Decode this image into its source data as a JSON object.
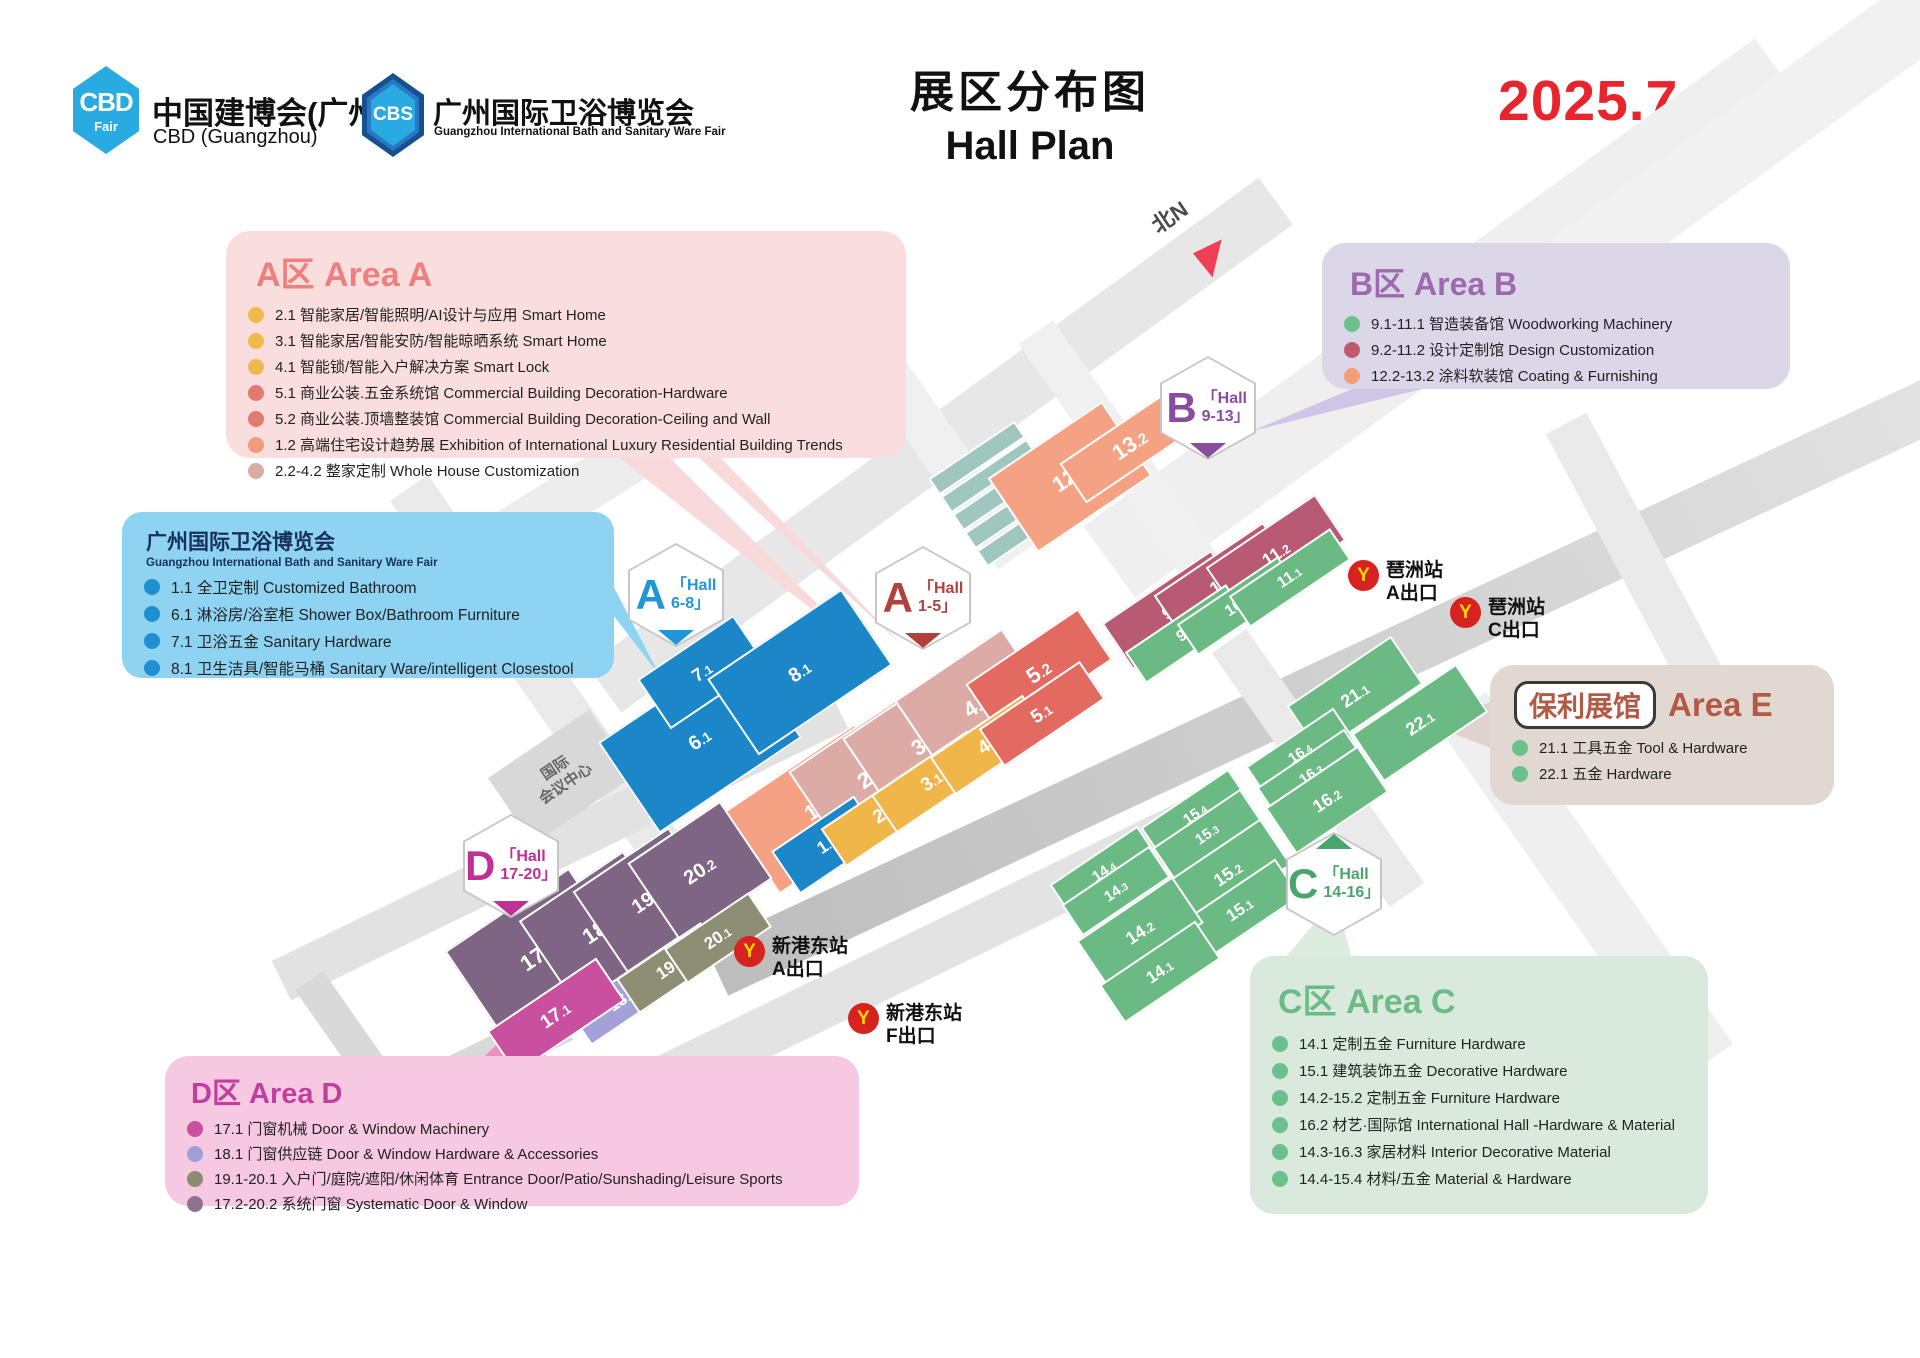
{
  "header": {
    "cbd_logo": {
      "line1": "CBD",
      "line2": "Fair"
    },
    "cbd_title": "中国建博会(广州)",
    "cbd_subtitle": "CBD (Guangzhou)",
    "cbs_logo": "CBS",
    "cbs_title": "广州国际卫浴博览会",
    "cbs_subtitle": "Guangzhou International Bath and Sanitary Ware Fair",
    "title_cn": "展区分布图",
    "title_en": "Hall Plan",
    "date": "2025.7.8-11"
  },
  "legends": {
    "area_a": {
      "title": "A区 Area A",
      "items": [
        {
          "dot": "#f0b94b",
          "text": "2.1 智能家居/智能照明/AI设计与应用 Smart Home"
        },
        {
          "dot": "#f0b94b",
          "text": "3.1 智能家居/智能安防/智能晾晒系统 Smart Home"
        },
        {
          "dot": "#f0b94b",
          "text": "4.1 智能锁/智能入户解决方案 Smart Lock"
        },
        {
          "dot": "#e27a72",
          "text": "5.1 商业公装.五金系统馆 Commercial Building Decoration-Hardware"
        },
        {
          "dot": "#e27a72",
          "text": "5.2 商业公装.顶墙整装馆 Commercial Building Decoration-Ceiling and Wall"
        },
        {
          "dot": "#f29b7d",
          "text": "1.2 高端住宅设计趋势展 Exhibition of International Luxury Residential Building Trends"
        },
        {
          "dot": "#d9aca6",
          "text": "2.2-4.2 整家定制 Whole House Customization"
        }
      ]
    },
    "area_b": {
      "title": "B区 Area B",
      "items": [
        {
          "dot": "#6cc08b",
          "text": "9.1-11.1 智造装备馆 Woodworking Machinery"
        },
        {
          "dot": "#c05a72",
          "text": "9.2-11.2 设计定制馆 Design Customization"
        },
        {
          "dot": "#f59d76",
          "text": "12.2-13.2 涂料软装馆 Coating & Furnishing"
        }
      ]
    },
    "bath": {
      "title": "广州国际卫浴博览会",
      "subtitle": "Guangzhou International Bath and Sanitary Ware Fair",
      "items": [
        {
          "dot": "#1f8fd0",
          "text": "1.1 全卫定制 Customized Bathroom"
        },
        {
          "dot": "#1f8fd0",
          "text": "6.1 淋浴房/浴室柜 Shower Box/Bathroom Furniture"
        },
        {
          "dot": "#1f8fd0",
          "text": "7.1 卫浴五金 Sanitary Hardware"
        },
        {
          "dot": "#1f8fd0",
          "text": "8.1 卫生洁具/智能马桶 Sanitary Ware/intelligent Closestool"
        }
      ]
    },
    "area_e": {
      "badge": "保利展馆",
      "title": "Area E",
      "items": [
        {
          "dot": "#6cc08b",
          "text": "21.1 工具五金 Tool & Hardware"
        },
        {
          "dot": "#6cc08b",
          "text": "22.1 五金 Hardware"
        }
      ]
    },
    "area_c": {
      "title": "C区 Area C",
      "items": [
        {
          "dot": "#6cc08b",
          "text": "14.1 定制五金 Furniture Hardware"
        },
        {
          "dot": "#6cc08b",
          "text": "15.1 建筑装饰五金 Decorative Hardware"
        },
        {
          "dot": "#6cc08b",
          "text": "14.2-15.2 定制五金 Furniture Hardware"
        },
        {
          "dot": "#6cc08b",
          "text": "16.2 材艺·国际馆 International Hall -Hardware & Material"
        },
        {
          "dot": "#6cc08b",
          "text": "14.3-16.3 家居材料 Interior Decorative Material"
        },
        {
          "dot": "#6cc08b",
          "text": "14.4-15.4 材料/五金 Material & Hardware"
        }
      ]
    },
    "area_d": {
      "title": "D区 Area D",
      "items": [
        {
          "dot": "#c8519f",
          "text": "17.1 门窗机械 Door & Window Machinery"
        },
        {
          "dot": "#9f9fd6",
          "text": "18.1 门窗供应链 Door & Window Hardware & Accessories"
        },
        {
          "dot": "#8b8b74",
          "text": "19.1-20.1 入户门/庭院/遮阳/休闲体育 Entrance Door/Patio/Sunshading/Leisure Sports"
        },
        {
          "dot": "#8d7390",
          "text": "17.2-20.2 系统门窗 Systematic Door & Window"
        }
      ]
    }
  },
  "map": {
    "north_label": "北N",
    "conference_center_line1": "国际",
    "conference_center_line2": "会议中心",
    "hexagons": {
      "a68": {
        "letter": "A",
        "line1": "「Hall",
        "line2": "6-8」",
        "color": "#2196d6"
      },
      "a15": {
        "letter": "A",
        "line1": "「Hall",
        "line2": "1-5」",
        "color": "#b0413c"
      },
      "b913": {
        "letter": "B",
        "line1": "「Hall",
        "line2": "9-13」",
        "color": "#8a4d9e"
      },
      "c1416": {
        "letter": "C",
        "line1": "「Hall",
        "line2": "14-16」",
        "color": "#4aa56d"
      },
      "d1720": {
        "letter": "D",
        "line1": "「Hall",
        "line2": "17-20」",
        "color": "#bf2f96"
      }
    },
    "stations": [
      {
        "name": "琶洲站",
        "exit": "A出口",
        "logo": "Y"
      },
      {
        "name": "琶洲站",
        "exit": "C出口",
        "logo": "Y"
      },
      {
        "name": "新港东站",
        "exit": "A出口",
        "logo": "Y"
      },
      {
        "name": "新港东站",
        "exit": "F出口",
        "logo": "Y"
      }
    ],
    "halls": [
      {
        "id": "6.1",
        "label": "6.1",
        "color": "#1b87c9"
      },
      {
        "id": "7.1",
        "label": "7.1",
        "color": "#1b87c9"
      },
      {
        "id": "8.1",
        "label": "8.1",
        "color": "#1b87c9"
      },
      {
        "id": "1.2",
        "label": "1.2",
        "color": "#f5a183"
      },
      {
        "id": "2.2",
        "label": "2.2",
        "color": "#dcaba5"
      },
      {
        "id": "3.2",
        "label": "3.2",
        "color": "#dcaba5"
      },
      {
        "id": "4.2",
        "label": "4.2",
        "color": "#dcaba5"
      },
      {
        "id": "5.2",
        "label": "5.2",
        "color": "#e26a60"
      },
      {
        "id": "1.1",
        "label": "1.1",
        "color": "#1b87c9"
      },
      {
        "id": "2.1",
        "label": "2.1",
        "color": "#f1b64a"
      },
      {
        "id": "3.1",
        "label": "3.1",
        "color": "#f1b64a"
      },
      {
        "id": "4.1",
        "label": "4.1",
        "color": "#f1b64a"
      },
      {
        "id": "5.1",
        "label": "5.1",
        "color": "#e26a60"
      },
      {
        "id": "12.2",
        "label": "12.2",
        "color": "#f5a183"
      },
      {
        "id": "13.2",
        "label": "13.2",
        "color": "#f5a183"
      },
      {
        "id": "9.2",
        "label": "9.2",
        "color": "#b85a74"
      },
      {
        "id": "10.2",
        "label": "10.2",
        "color": "#b85a74"
      },
      {
        "id": "11.2",
        "label": "11.2",
        "color": "#b85a74"
      },
      {
        "id": "9.1",
        "label": "9.1",
        "color": "#6cba83"
      },
      {
        "id": "10.1",
        "label": "10.1",
        "color": "#6cba83"
      },
      {
        "id": "11.1",
        "label": "11.1",
        "color": "#6cba83"
      },
      {
        "id": "21.1",
        "label": "21.1",
        "color": "#6cba83"
      },
      {
        "id": "22.1",
        "label": "22.1",
        "color": "#6cba83"
      },
      {
        "id": "16.4",
        "label": "16.4",
        "color": "#6cba83"
      },
      {
        "id": "16.3",
        "label": "16.3",
        "color": "#6cba83"
      },
      {
        "id": "16.2",
        "label": "16.2",
        "color": "#6cba83"
      },
      {
        "id": "15.4",
        "label": "15.4",
        "color": "#6cba83"
      },
      {
        "id": "15.3",
        "label": "15.3",
        "color": "#6cba83"
      },
      {
        "id": "15.2",
        "label": "15.2",
        "color": "#6cba83"
      },
      {
        "id": "15.1",
        "label": "15.1",
        "color": "#6cba83"
      },
      {
        "id": "14.4",
        "label": "14.4",
        "color": "#6cba83"
      },
      {
        "id": "14.3",
        "label": "14.3",
        "color": "#6cba83"
      },
      {
        "id": "14.2",
        "label": "14.2",
        "color": "#6cba83"
      },
      {
        "id": "14.1",
        "label": "14.1",
        "color": "#6cba83"
      },
      {
        "id": "17.2",
        "label": "17.2",
        "color": "#7e6583"
      },
      {
        "id": "18.2",
        "label": "18.2",
        "color": "#7e6583"
      },
      {
        "id": "19.2",
        "label": "19.2",
        "color": "#7e6583"
      },
      {
        "id": "20.2",
        "label": "20.2",
        "color": "#7e6583"
      },
      {
        "id": "18.1",
        "label": "18.1",
        "color": "#a2a2d8"
      },
      {
        "id": "19.1",
        "label": "19.1",
        "color": "#8e8e75"
      },
      {
        "id": "20.1",
        "label": "20.1",
        "color": "#8e8e75"
      },
      {
        "id": "17.1",
        "label": "17.1",
        "color": "#c9509e"
      }
    ]
  }
}
